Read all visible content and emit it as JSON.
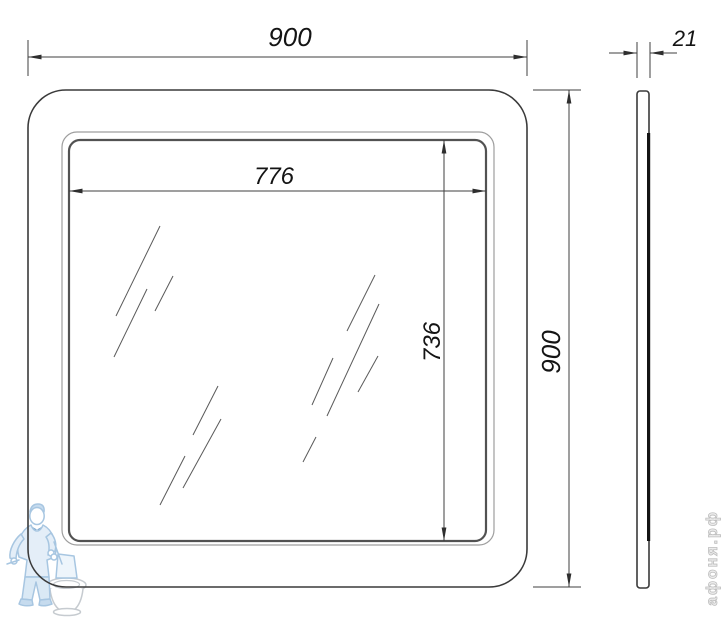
{
  "drawing": {
    "title": "mirror-dimension-drawing",
    "views": {
      "front": "front view",
      "side": "side view"
    }
  },
  "dims": {
    "overall_width": "900",
    "overall_height": "900",
    "glass_width": "776",
    "glass_height": "736",
    "depth": "21"
  },
  "watermark": {
    "text": "афоня.рф",
    "logo": "plumber-with-toilet"
  },
  "colors": {
    "outline": "#3a3a3a",
    "dimension_line": "#3f3f3f",
    "thin_frame": "#9e9e9e",
    "glass_edge": "#525252",
    "reflection": "#5a5a5a",
    "watermark_blue": "#a3c3e0",
    "watermark_blue_fill": "#dcead7",
    "watermark_gray": "#c4c9ce",
    "watermark_text_gray": "#bdbdbd"
  },
  "reflections": [
    [
      116,
      316,
      160,
      226
    ],
    [
      114,
      357,
      147,
      289
    ],
    [
      155,
      311,
      173,
      276
    ],
    [
      193,
      435,
      218,
      386
    ],
    [
      183,
      488,
      221,
      419
    ],
    [
      160,
      505,
      185,
      456
    ],
    [
      347,
      331,
      375,
      275
    ],
    [
      327,
      416,
      379,
      304
    ],
    [
      312,
      405,
      333,
      358
    ],
    [
      358,
      392,
      378,
      356
    ],
    [
      303,
      462,
      316,
      437
    ]
  ]
}
